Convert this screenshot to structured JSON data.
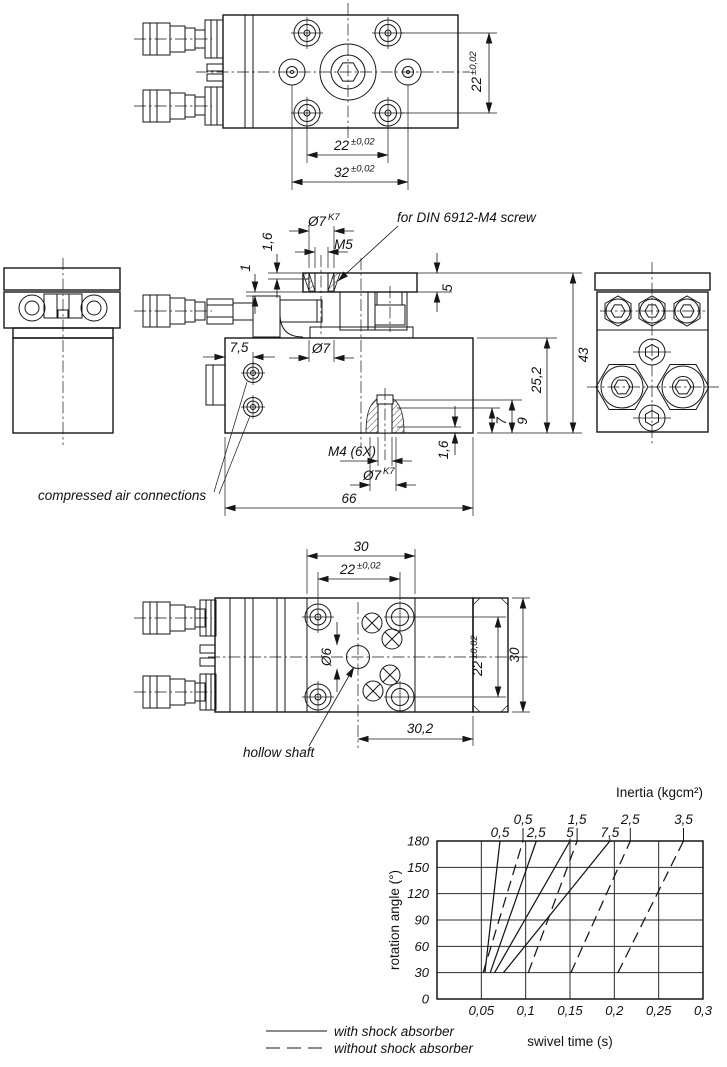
{
  "top_view": {
    "dim_side": {
      "val": "22",
      "tol": "±0,02"
    },
    "dim_pitch": {
      "val": "22",
      "tol": "±0,02"
    },
    "dim_width": {
      "val": "32",
      "tol": "±0,02"
    }
  },
  "front_view": {
    "dim_fit_top": {
      "val": "Ø7",
      "fit": "K7"
    },
    "dim_thread_top": "M5",
    "dim_depth_top": "1,6",
    "dim_gap": "1",
    "dim_port_offset": "7,5",
    "dim_bore": "Ø7",
    "dim_plate_thickness": "5",
    "dim_total_height": "43",
    "dim_body_height": "25,2",
    "dim_screw_depth": "7",
    "dim_boss_height": "9",
    "dim_thread_bottom": "M4 (6X)",
    "dim_depth_bottom": "1,6",
    "dim_fit_bottom": {
      "val": "Ø7",
      "fit": "K7"
    },
    "dim_length": "66",
    "note_screw": "for DIN 6912-M4 screw",
    "note_air": "compressed air connections"
  },
  "bottom_view": {
    "dim_module_width": "30",
    "dim_pitch_top": {
      "val": "22",
      "tol": "±0,02"
    },
    "dim_shaft_bore": "Ø6",
    "dim_pitch_right": {
      "val": "22",
      "tol": "±0,02"
    },
    "dim_module_height": "30",
    "dim_offset": "30,2",
    "note_shaft": "hollow shaft"
  },
  "chart_data": {
    "type": "line",
    "title": "Inertia (kgcm²)",
    "xlabel": "swivel time (s)",
    "ylabel": "rotation angle (°)",
    "xlim": [
      0,
      0.3
    ],
    "ylim": [
      0,
      180
    ],
    "xticks": [
      "0,05",
      "0,1",
      "0,15",
      "0,2",
      "0,25",
      "0,3"
    ],
    "yticks": [
      "0",
      "30",
      "60",
      "90",
      "120",
      "150",
      "180"
    ],
    "grid": true,
    "series": [
      {
        "name": "0,5",
        "style": "solid",
        "group": "with shock absorber",
        "tick": false,
        "points": [
          [
            0.054,
            30
          ],
          [
            0.071,
            180
          ]
        ]
      },
      {
        "name": "2,5",
        "style": "solid",
        "group": "with shock absorber",
        "tick": false,
        "points": [
          [
            0.06,
            30
          ],
          [
            0.112,
            180
          ]
        ]
      },
      {
        "name": "5",
        "style": "solid",
        "group": "with shock absorber",
        "tick": true,
        "points": [
          [
            0.065,
            30
          ],
          [
            0.15,
            180
          ]
        ]
      },
      {
        "name": "7,5",
        "style": "solid",
        "group": "with shock absorber",
        "tick": true,
        "points": [
          [
            0.075,
            30
          ],
          [
            0.195,
            180
          ]
        ]
      },
      {
        "name": "0,5",
        "style": "dashed",
        "group": "without shock absorber",
        "tick": true,
        "points": [
          [
            0.052,
            30
          ],
          [
            0.097,
            180
          ]
        ]
      },
      {
        "name": "1,5",
        "style": "dashed",
        "group": "without shock absorber",
        "tick": true,
        "points": [
          [
            0.103,
            30
          ],
          [
            0.158,
            180
          ]
        ]
      },
      {
        "name": "2,5",
        "style": "dashed",
        "group": "without shock absorber",
        "tick": true,
        "points": [
          [
            0.151,
            30
          ],
          [
            0.218,
            180
          ]
        ]
      },
      {
        "name": "3,5",
        "style": "dashed",
        "group": "without shock absorber",
        "tick": true,
        "points": [
          [
            0.204,
            30
          ],
          [
            0.278,
            180
          ]
        ]
      }
    ]
  },
  "legend": {
    "solid_label": "with shock absorber",
    "dashed_label": "without shock absorber"
  }
}
